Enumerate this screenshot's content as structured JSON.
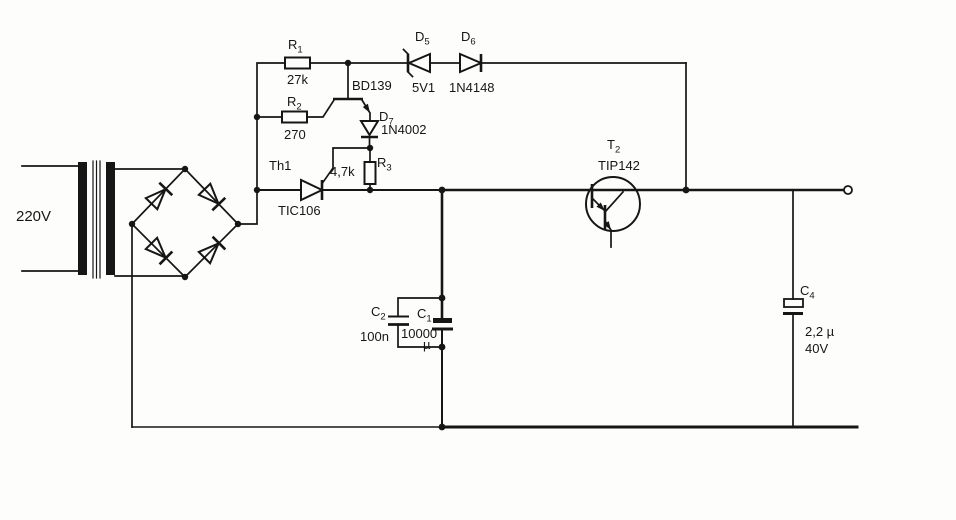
{
  "diagram": {
    "kind": "power-supply circuit schematic (scanned)",
    "background_color": "#fdfdfb",
    "ink_color": "#161616"
  },
  "components": {
    "mains": {
      "value": "220V"
    },
    "r1": {
      "ref": "R",
      "sub": "1",
      "value": "27k"
    },
    "r2": {
      "ref": "R",
      "sub": "2",
      "value": "270"
    },
    "r3": {
      "ref": "R",
      "sub": "3",
      "value": "4,7k"
    },
    "q1": {
      "ref": "BD139"
    },
    "d5": {
      "ref": "D",
      "sub": "5",
      "value": "5V1"
    },
    "d6": {
      "ref": "D",
      "sub": "6",
      "value": "1N4148"
    },
    "d7": {
      "ref": "D",
      "sub": "7",
      "value": "1N4002"
    },
    "th1": {
      "ref": "Th1",
      "value": "TIC106"
    },
    "t2": {
      "ref": "T",
      "sub": "2",
      "value": "TIP142"
    },
    "c1": {
      "ref": "C",
      "sub": "1",
      "value": "10000",
      "unit": "µ"
    },
    "c2": {
      "ref": "C",
      "sub": "2",
      "value": "100n"
    },
    "c4": {
      "ref": "C",
      "sub": "4",
      "value": "2,2 µ",
      "rating": "40V"
    }
  }
}
